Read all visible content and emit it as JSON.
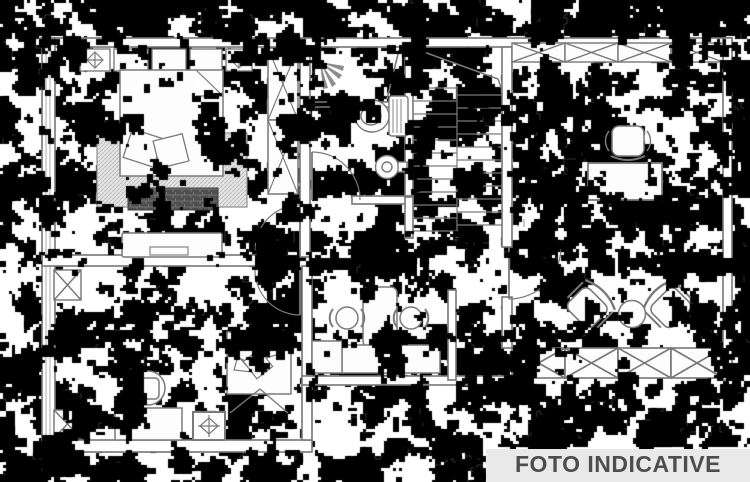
{
  "banner": {
    "label": "FOTO INDICATIVE",
    "background_color": "#e9e9e9",
    "text_color": "#4d4d4d"
  },
  "image": {
    "background_color": "#ffffff",
    "line_color": "#767676",
    "noise_color": "#000000"
  }
}
